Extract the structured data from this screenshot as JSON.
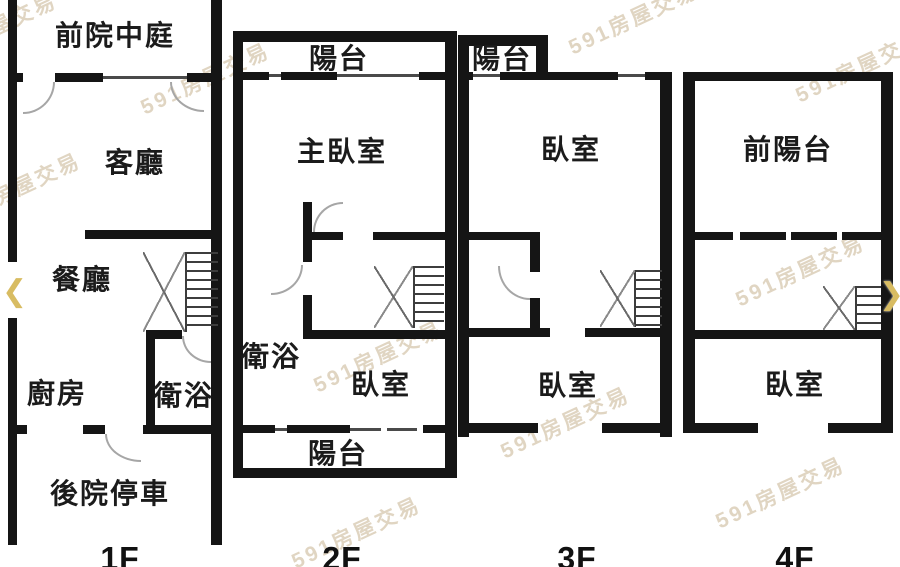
{
  "watermark": {
    "text": "591房屋交易",
    "color": "#c7b28f"
  },
  "carousel": {
    "prev_icon": "❮",
    "next_icon": "❯",
    "color": "#d8bc62"
  },
  "colors": {
    "wall": "#151515",
    "background": "#ffffff"
  },
  "floors": [
    {
      "floor_label": "1F",
      "rooms": {
        "front_courtyard": "前院中庭",
        "living_room": "客廳",
        "dining_room": "餐廳",
        "kitchen": "廚房",
        "bathroom": "衛浴",
        "backyard_parking": "後院停車"
      }
    },
    {
      "floor_label": "2F",
      "rooms": {
        "balcony_front": "陽台",
        "master_bedroom": "主臥室",
        "bathroom": "衛浴",
        "bedroom": "臥室",
        "balcony_back": "陽台"
      }
    },
    {
      "floor_label": "3F",
      "rooms": {
        "balcony": "陽台",
        "bedroom_front": "臥室",
        "bedroom_back": "臥室"
      }
    },
    {
      "floor_label": "4F",
      "rooms": {
        "front_balcony": "前陽台",
        "bedroom": "臥室"
      }
    }
  ]
}
